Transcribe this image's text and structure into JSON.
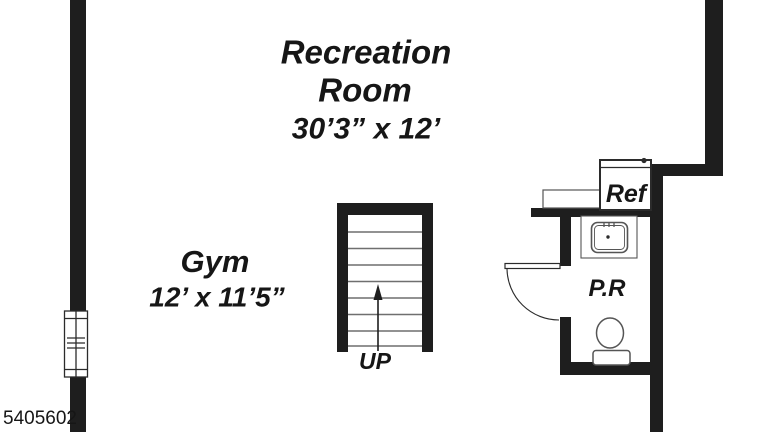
{
  "colors": {
    "background": "#ffffff",
    "wall": "#1e1e1e",
    "tread_line": "#6f6f6f",
    "fixture_line": "#555555",
    "fixture_dark": "#2b2b2b",
    "text": "#161616"
  },
  "rooms": {
    "recreation": {
      "name_line1": "Recreation",
      "name_line2": "Room",
      "dims": "30’3” x 12’"
    },
    "gym": {
      "name": "Gym",
      "dims": "12’ x 11’5”"
    },
    "powder_room": {
      "name": "P.R"
    }
  },
  "fixtures": {
    "refrigerator_label": "Ref"
  },
  "stairs": {
    "direction_label": "UP"
  },
  "footer": {
    "number": "5405602"
  }
}
